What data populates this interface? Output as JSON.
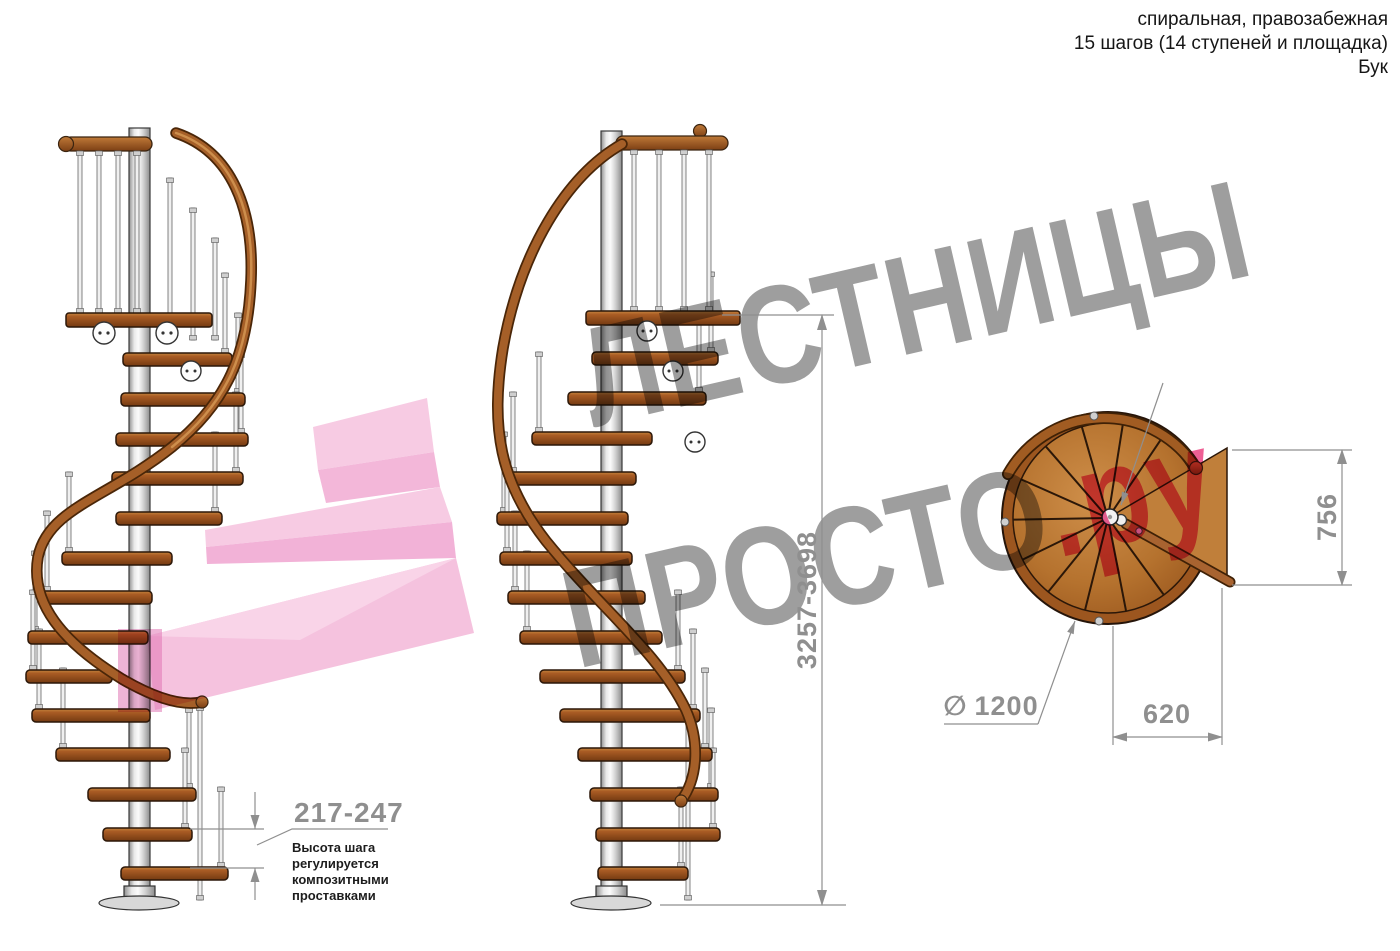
{
  "header": {
    "line1": "спиральная, правозабежная",
    "line2": "15 шагов (14 ступеней и площадка)",
    "line3": "Бук"
  },
  "watermark": {
    "line1": "ЛЕСТНИЦЫ",
    "line2": "ПРОСТО",
    "suffix": ".ру"
  },
  "dimensions": {
    "total_height": "3257-3698",
    "landing_depth": "756",
    "exit_width": "620",
    "diameter_symbol": "∅",
    "diameter_value": "1200",
    "step_height": "217-247"
  },
  "annotation": {
    "step_height_note": "Высота шага\nрегулируется\nкомпозитными\nпроставками"
  },
  "colors": {
    "wood": "#a95d22",
    "rail": "#a55f28",
    "pole": "#d9d9d9",
    "dimension_gray": "#8f8f8f",
    "watermark_gray": "#9e9e9e",
    "watermark_pink": "#ee5f94",
    "arrow_pink": "#f5c0de"
  }
}
